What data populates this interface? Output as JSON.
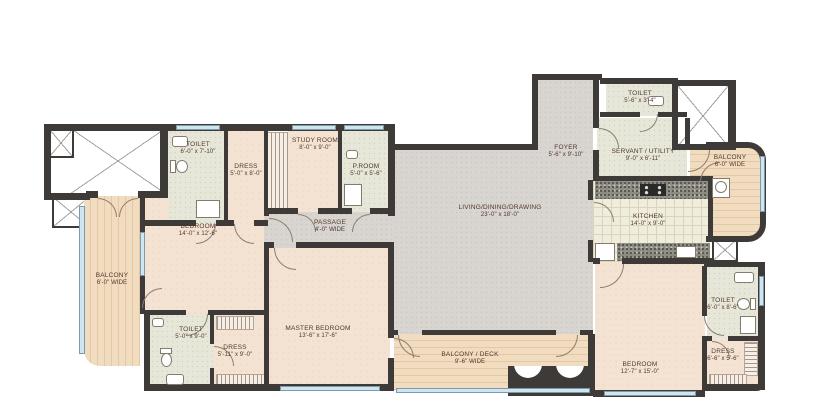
{
  "title": "apartment-floor-plan",
  "rooms": {
    "toilet_tl": {
      "name": "TOILET",
      "dims": "6'-0\" x 7'-10\""
    },
    "dress_tl": {
      "name": "DRESS",
      "dims": "5'-0\" x 8'-0\""
    },
    "study": {
      "name": "STUDY ROOM",
      "dims": "8'-0\" x 9'-0\""
    },
    "p_room": {
      "name": "P.ROOM",
      "dims": "5'-0\" x 5'-6\""
    },
    "passage": {
      "name": "PASSAGE",
      "dims": "4'-0\" WIDE"
    },
    "bedroom1": {
      "name": "BEDROOM",
      "dims": "14'-0\" x 12'-6\""
    },
    "balcony_left": {
      "name": "BALCONY",
      "dims": "6'-0\" WIDE"
    },
    "toilet_bl": {
      "name": "TOILET",
      "dims": "5'-0\" x 9'-0\""
    },
    "dress_bl": {
      "name": "DRESS",
      "dims": "5'-11\" x 9'-0\""
    },
    "master_bedroom": {
      "name": "MASTER BEDROOM",
      "dims": "13'-6\" x 17'-6\""
    },
    "living": {
      "name": "LIVING/DINING/DRAWING",
      "dims": "23'-0\" x 18'-0\""
    },
    "foyer": {
      "name": "FOYER",
      "dims": "5'-6\" x 9'-10\""
    },
    "balcony_deck": {
      "name": "BALCONY / DECK",
      "dims": "9'-6\" WIDE"
    },
    "toilet_tr": {
      "name": "TOILET",
      "dims": "5'-6\" x 3'-4\""
    },
    "servant": {
      "name": "SERVANT / UTILITY",
      "dims": "9'-0\" x 6'-11\""
    },
    "kitchen": {
      "name": "KITCHEN",
      "dims": "14'-0\" x 9'-0\""
    },
    "balcony_right": {
      "name": "BALCONY",
      "dims": "6'-0\" WIDE"
    },
    "bedroom2": {
      "name": "BEDROOM",
      "dims": "12'-7\" x 15'-0\""
    },
    "toilet_br": {
      "name": "TOILET",
      "dims": "6'-0\" x 8'-6\""
    },
    "dress_br": {
      "name": "DRESS",
      "dims": "6'-6\" x 5'-6\""
    }
  },
  "colors": {
    "wall": "#3d3a37",
    "bedroom_floor": "#f4e3d2",
    "living_floor": "#d8d4d0",
    "tile_floor": "#e6e7d9",
    "wood_floor": "#f1dcc0",
    "granite_counter": "#8e8d85",
    "window": "#cfe5ef",
    "label_text": "#50382b"
  }
}
